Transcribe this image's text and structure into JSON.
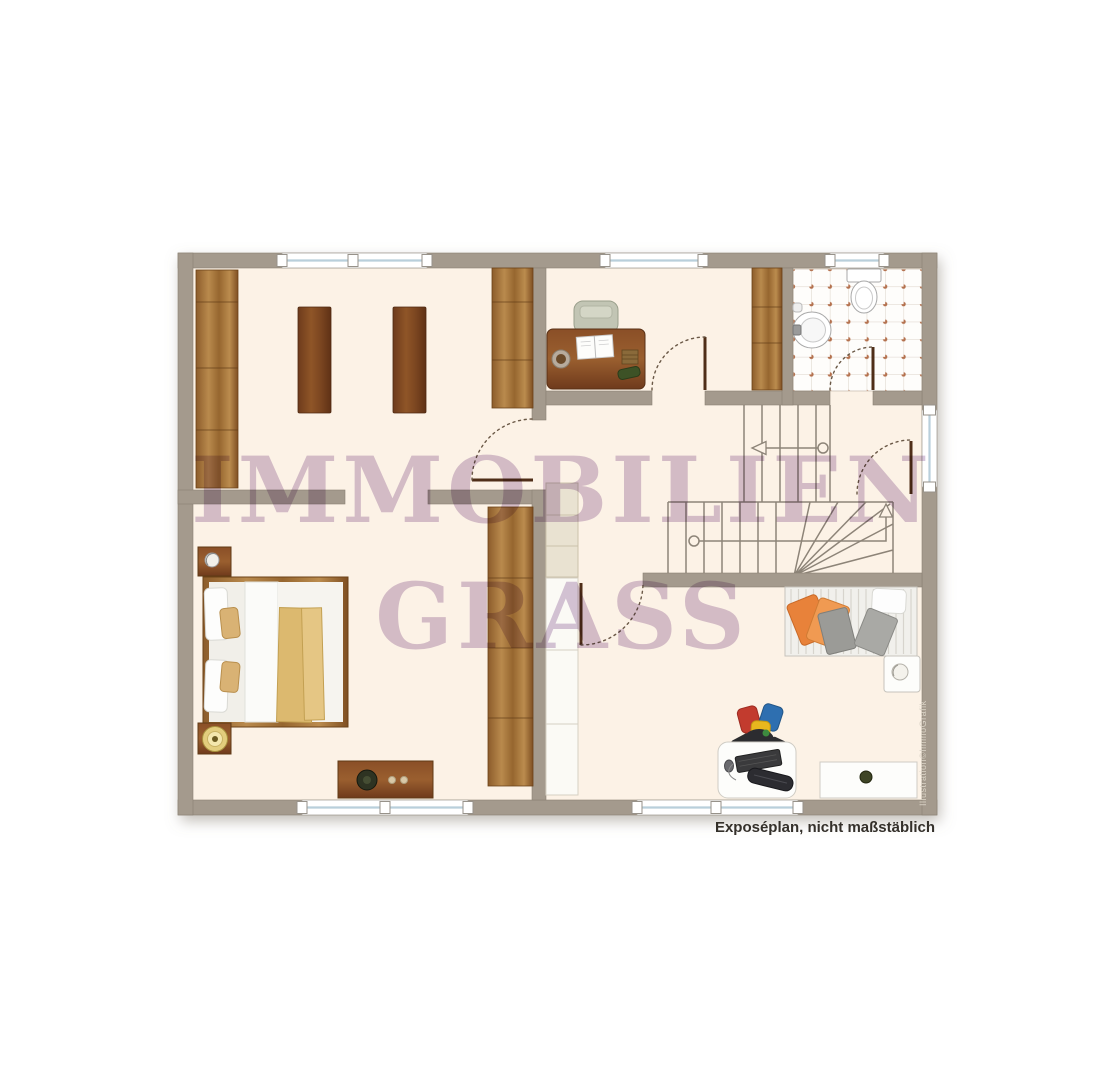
{
  "watermark": {
    "line1": "IMMOBILIEN",
    "line2": "GRASS",
    "color": "#b393bd"
  },
  "footer": {
    "caption": "Exposéplan, nicht maßstäblich"
  },
  "credit": {
    "text": "Illustration©ImmoGrafik"
  },
  "palette": {
    "wall": "#a49a8d",
    "floor": "#fcf2e6",
    "wood": "#9a6a33",
    "tile_dot": "#b4714e",
    "pillow_orange": "#e8823a",
    "blanket_yellow": "#dcb96f"
  }
}
